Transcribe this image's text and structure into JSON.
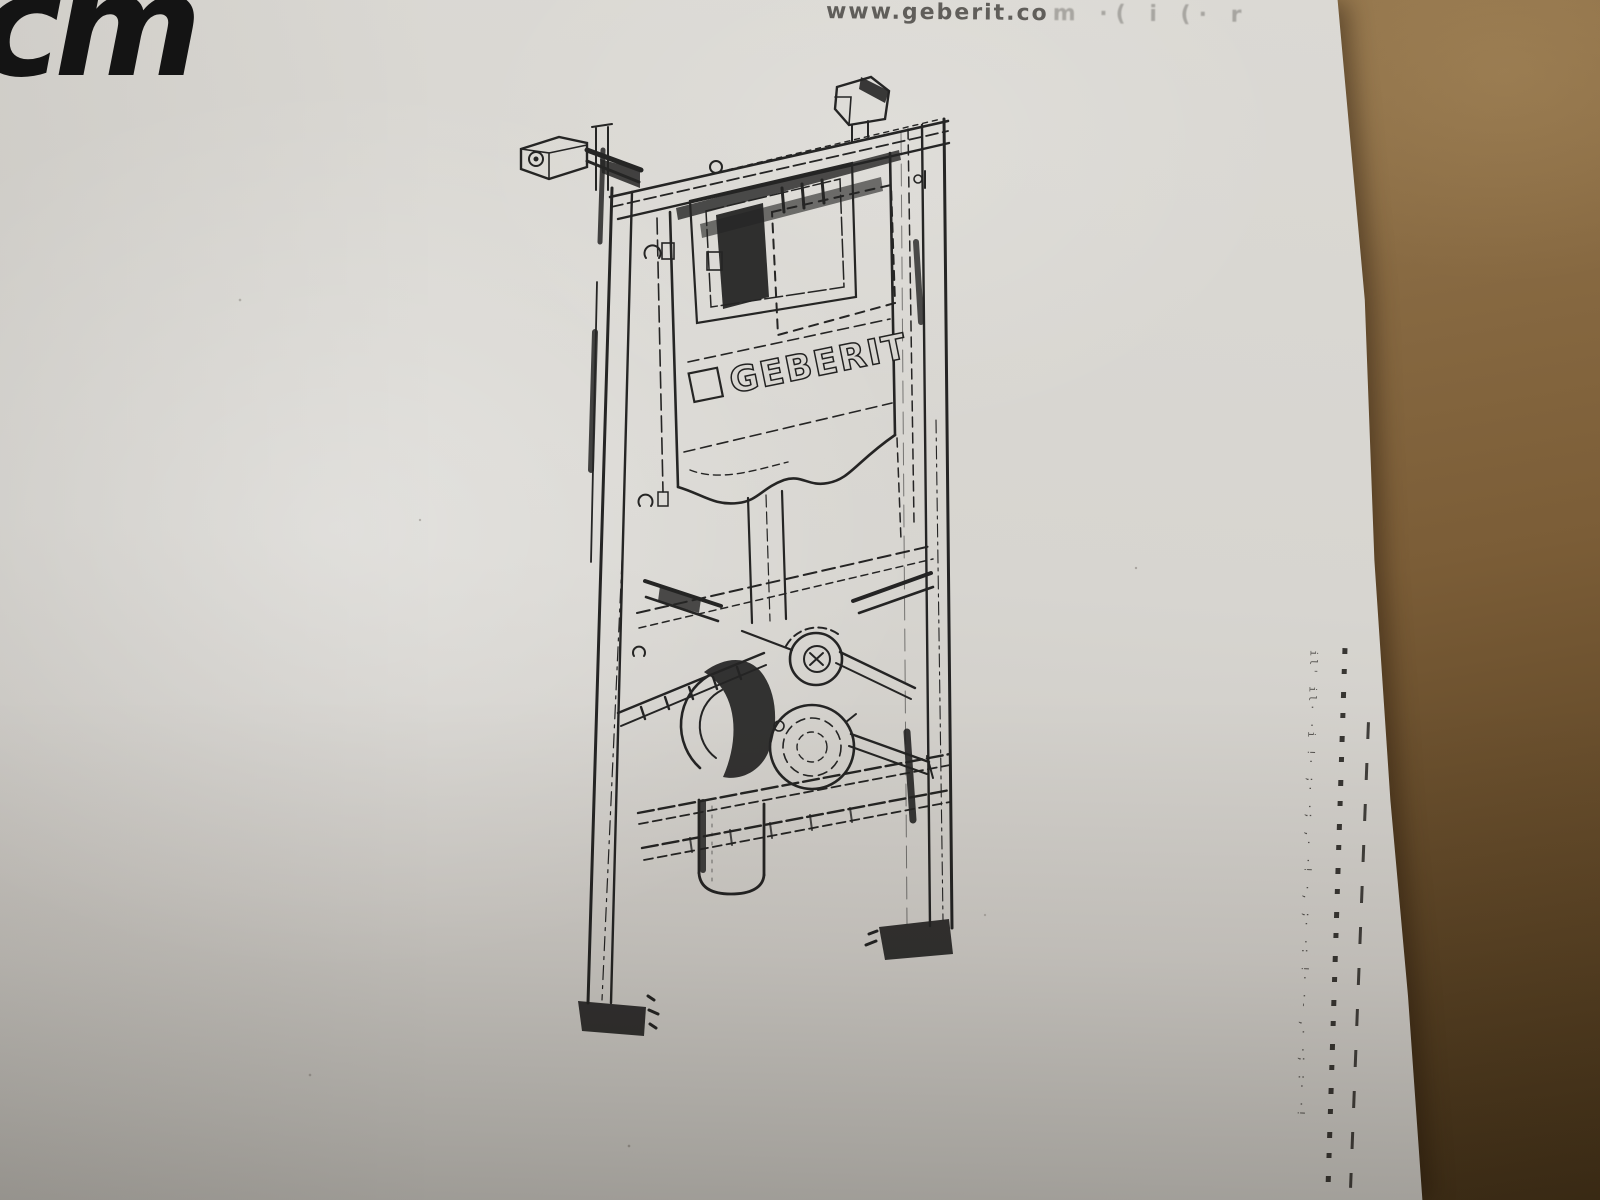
{
  "photo": {
    "paper": {
      "corner_mark": "cm",
      "url": "www.geberit.co",
      "url_faded_tail": "m ·( i (· r",
      "fine_print_column": "il' il· ·i !· ;· ·; ,· ·! ·, ;· ·: !· ·- ,· ·; :· ·!"
    },
    "diagram": {
      "brand": "GEBERIT",
      "subject": "concealed-cistern-mounting-frame"
    },
    "colors": {
      "paper": "#d7d5d0",
      "cardboard": "#8b6d45",
      "cardboard_dark": "#3f2e16",
      "ink": "#171717"
    }
  }
}
